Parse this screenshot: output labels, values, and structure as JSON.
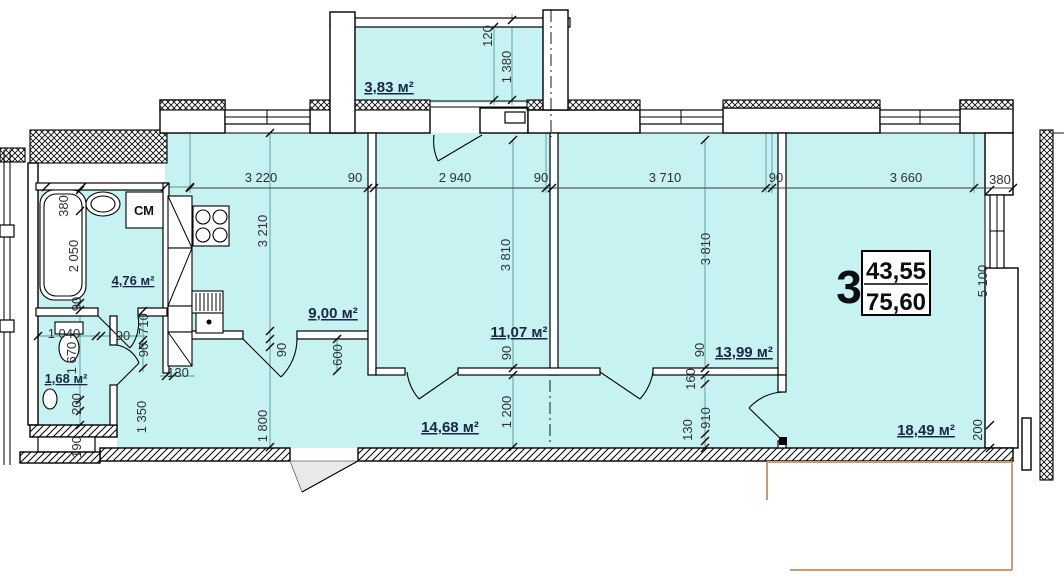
{
  "title": "Apartment floor plan",
  "unit": {
    "number": "3",
    "area_living": "43,55",
    "area_total": "75,60"
  },
  "rooms": {
    "balcony": "3,83 м²",
    "bathroom": "4,76 м²",
    "wc": "1,68 м²",
    "kitchen": "9,00 м²",
    "bedroom1": "11,07 м²",
    "bedroom2": "13,99 м²",
    "living": "18,49 м²",
    "hall": "14,68 м²"
  },
  "labels": {
    "washer": "СМ"
  },
  "dims": {
    "top": {
      "a": "3 220",
      "b": "90",
      "c": "2 940",
      "d": "90",
      "e": "3 710",
      "f": "90",
      "g": "3 660",
      "h": "380"
    },
    "balcony": {
      "a": "120",
      "b": "1 380"
    },
    "left": {
      "a": "380",
      "b": "2 050",
      "c": "90",
      "d": "1 040",
      "e": "1 670",
      "f": "90",
      "g": "710",
      "h": "90",
      "i": "130",
      "j": "200",
      "k": "190",
      "l": "1 350"
    },
    "kitchen": {
      "a": "3 210",
      "b": "90",
      "c": "600",
      "d": "1 800"
    },
    "mid": {
      "a": "3 810",
      "b": "90",
      "c": "1 200"
    },
    "room2col": {
      "a": "3 810",
      "b": "90",
      "c": "160",
      "d": "910",
      "e": "130"
    },
    "right": {
      "a": "5 100",
      "b": "200"
    }
  },
  "colors": {
    "floor": "#c6f2f2",
    "room_label": "#1a2745",
    "dim_text": "#2e2f36",
    "balcony_outline": "#c89b72"
  }
}
